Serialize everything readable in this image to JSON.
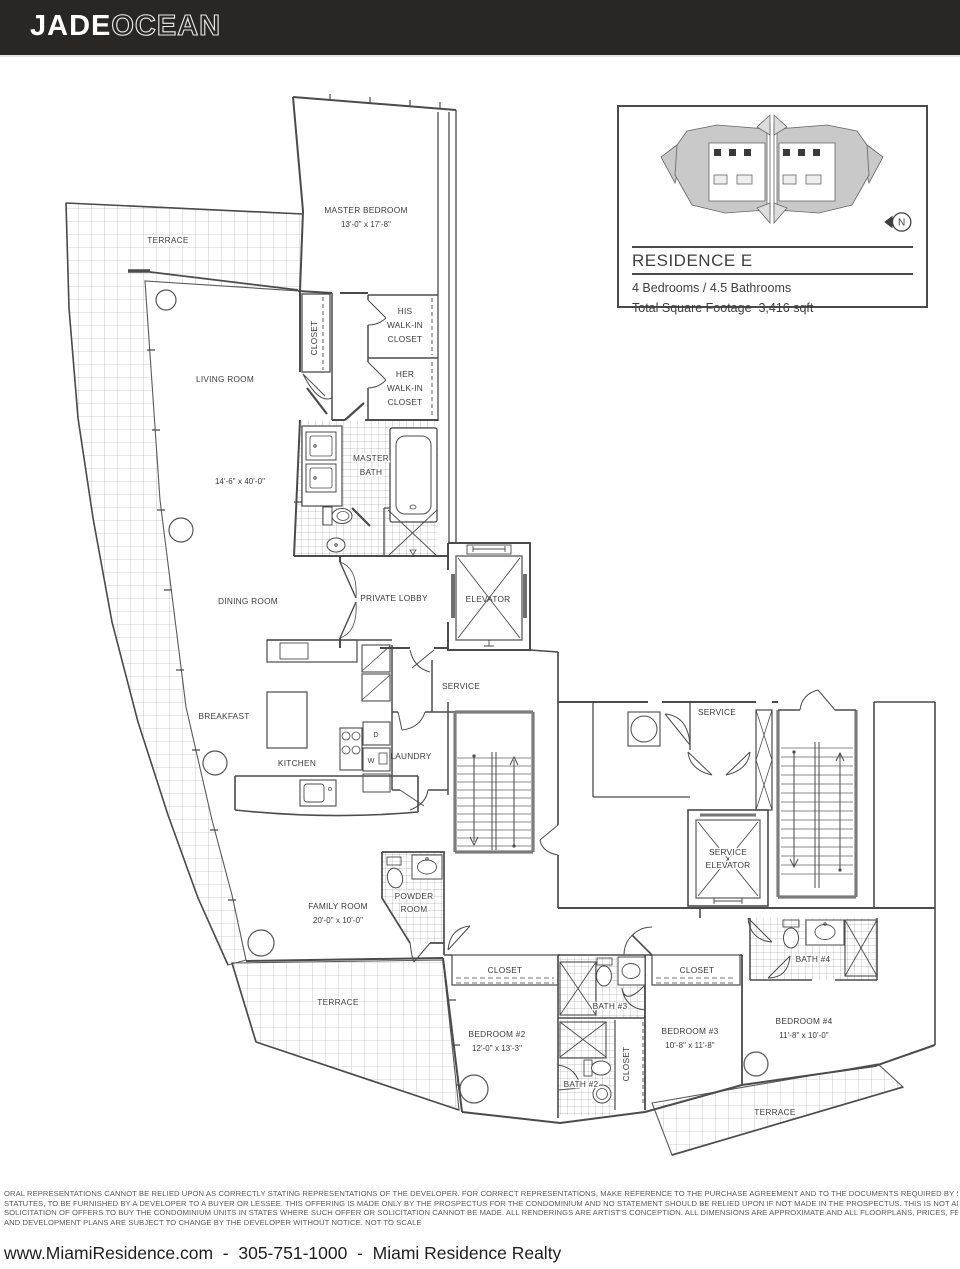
{
  "colors": {
    "header_bg": "#292623",
    "wall": "#4b4b4b",
    "keyplan_fill": "#c9c9c9"
  },
  "header": {
    "brand_primary": "JADE",
    "brand_secondary": "OCEAN"
  },
  "info_box": {
    "title": "RESIDENCE E",
    "beds_baths": "4 Bedrooms / 4.5 Bathrooms",
    "sqft": "Total Square Footage  3,416 sqft",
    "north_label": "N"
  },
  "plan": {
    "terrace_top": "TERRACE",
    "terrace_bottom_left": "TERRACE",
    "terrace_bottom_right": "TERRACE",
    "master_bedroom": [
      "MASTER BEDROOM",
      "13'-0\" x 17'-8\""
    ],
    "closet_master": "CLOSET",
    "his_closet": [
      "HIS",
      "WALK-IN",
      "CLOSET"
    ],
    "her_closet": [
      "HER",
      "WALK-IN",
      "CLOSET"
    ],
    "living_room": "LIVING ROOM",
    "living_room_dim": "14'-6\" x 40'-0\"",
    "master_bath": [
      "MASTER",
      "BATH"
    ],
    "dining_room": "DINING ROOM",
    "private_lobby": "PRIVATE LOBBY",
    "elevator": "ELEVATOR",
    "service_corridor": "SERVICE",
    "service_right": "SERVICE",
    "breakfast": "BREAKFAST",
    "kitchen": "KITCHEN",
    "dryer": "D",
    "washer": "W",
    "laundry": "LAUNDRY",
    "service_elevator": [
      "SERVICE",
      "ELEVATOR"
    ],
    "family_room": [
      "FAMILY ROOM",
      "20'-0\" x 10'-0\""
    ],
    "powder_room": [
      "POWDER",
      "ROOM"
    ],
    "closet_bedroom2": "CLOSET",
    "closet_bedroom3": "CLOSET",
    "closet_bedroom3_side": "CLOSET",
    "bath2": "BATH #2",
    "bath3": "BATH #3",
    "bath4": "BATH #4",
    "bedroom2": [
      "BEDROOM #2",
      "12'-0\" x 13'-3\""
    ],
    "bedroom3": [
      "BEDROOM #3",
      "10'-8\" x 11'-8\""
    ],
    "bedroom4": [
      "BEDROOM #4",
      "11'-8\" x 10'-0\""
    ]
  },
  "disclaimer": {
    "lines": [
      "ORAL REPRESENTATIONS CANNOT BE RELIED UPON AS CORRECTLY STATING REPRESENTATIONS OF THE DEVELOPER. FOR CORRECT REPRESENTATIONS, MAKE REFERENCE TO THE PURCHASE AGREEMENT AND TO THE DOCUMENTS REQUIRED BY SECTION 718.503 FLORIDA",
      "STATUTES, TO BE FURNISHED BY A DEVELOPER TO A BUYER OR LESSEE. THIS OFFERING IS MADE ONLY BY THE PROSPECTUS FOR THE CONDOMINIUM AND NO STATEMENT SHOULD BE RELIED UPON IF NOT MADE IN THE PROSPECTUS. THIS IS NOT AN OFFER TO SELL, OR",
      "SOLICITATION OF OFFERS TO BUY THE CONDOMINIUM UNITS IN STATES WHERE SUCH OFFER OR SOLICITATION CANNOT BE MADE. ALL RENDERINGS ARE ARTIST'S CONCEPTION. ALL DIMENSIONS ARE APPROXIMATE AND ALL FLOORPLANS, PRICES, FEATURES, SPECIFICATIONS",
      "AND DEVELOPMENT PLANS ARE SUBJECT TO CHANGE BY THE DEVELOPER WITHOUT NOTICE. NOT TO SCALE"
    ]
  },
  "footer": {
    "text": "www.MiamiResidence.com  -  305-751-1000  -  Miami Residence Realty"
  }
}
